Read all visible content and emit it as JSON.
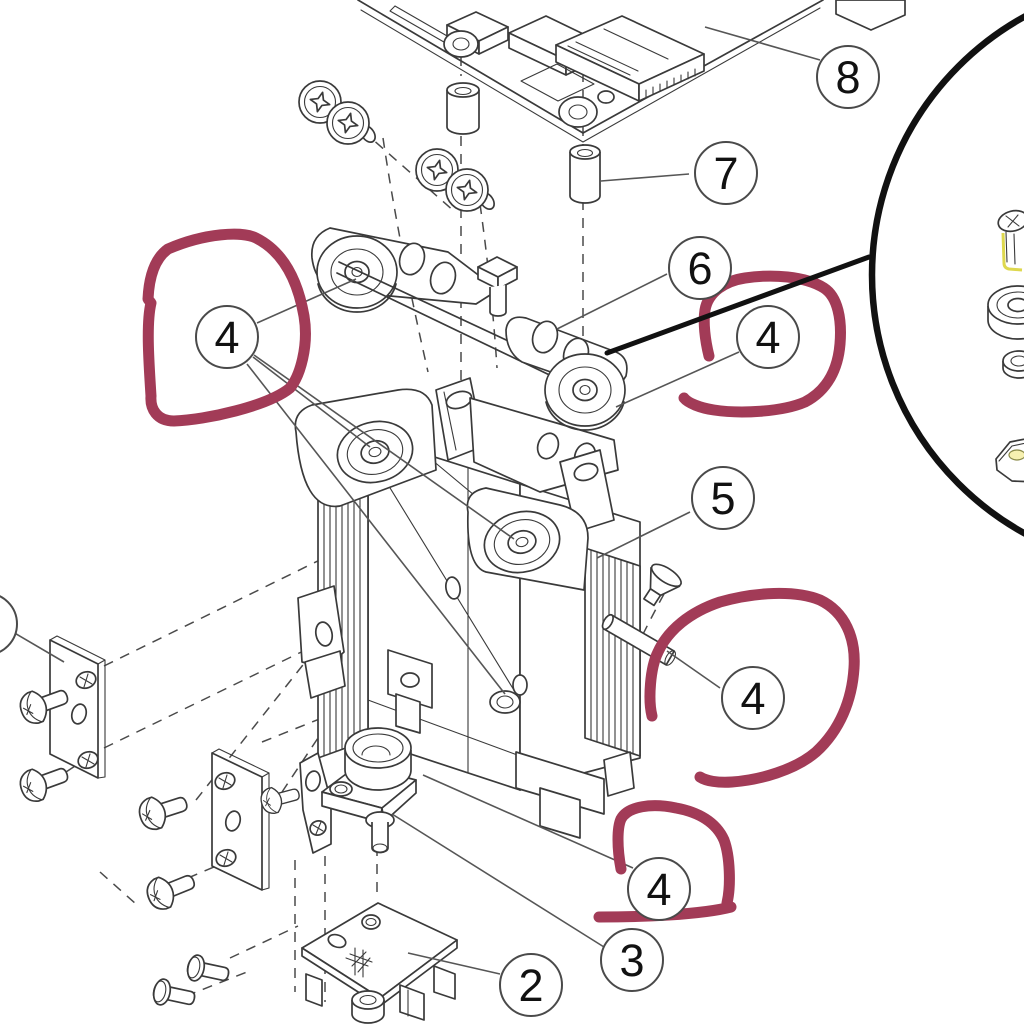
{
  "diagram": {
    "callouts": {
      "c2": {
        "label": "2"
      },
      "c3": {
        "label": "3"
      },
      "c4a": {
        "label": "4"
      },
      "c4b": {
        "label": "4"
      },
      "c4c": {
        "label": "4"
      },
      "c4d": {
        "label": "4"
      },
      "c5": {
        "label": "5"
      },
      "c6": {
        "label": "6"
      },
      "c7": {
        "label": "7"
      },
      "c8": {
        "label": "8"
      },
      "cPartialLeft": {
        "label": ""
      }
    },
    "colors": {
      "line": "#3a3a3a",
      "leader": "#565656",
      "annotation": "#a23b57",
      "highlight": "#ded84e",
      "pointer": "#111111",
      "background": "#ffffff"
    }
  }
}
